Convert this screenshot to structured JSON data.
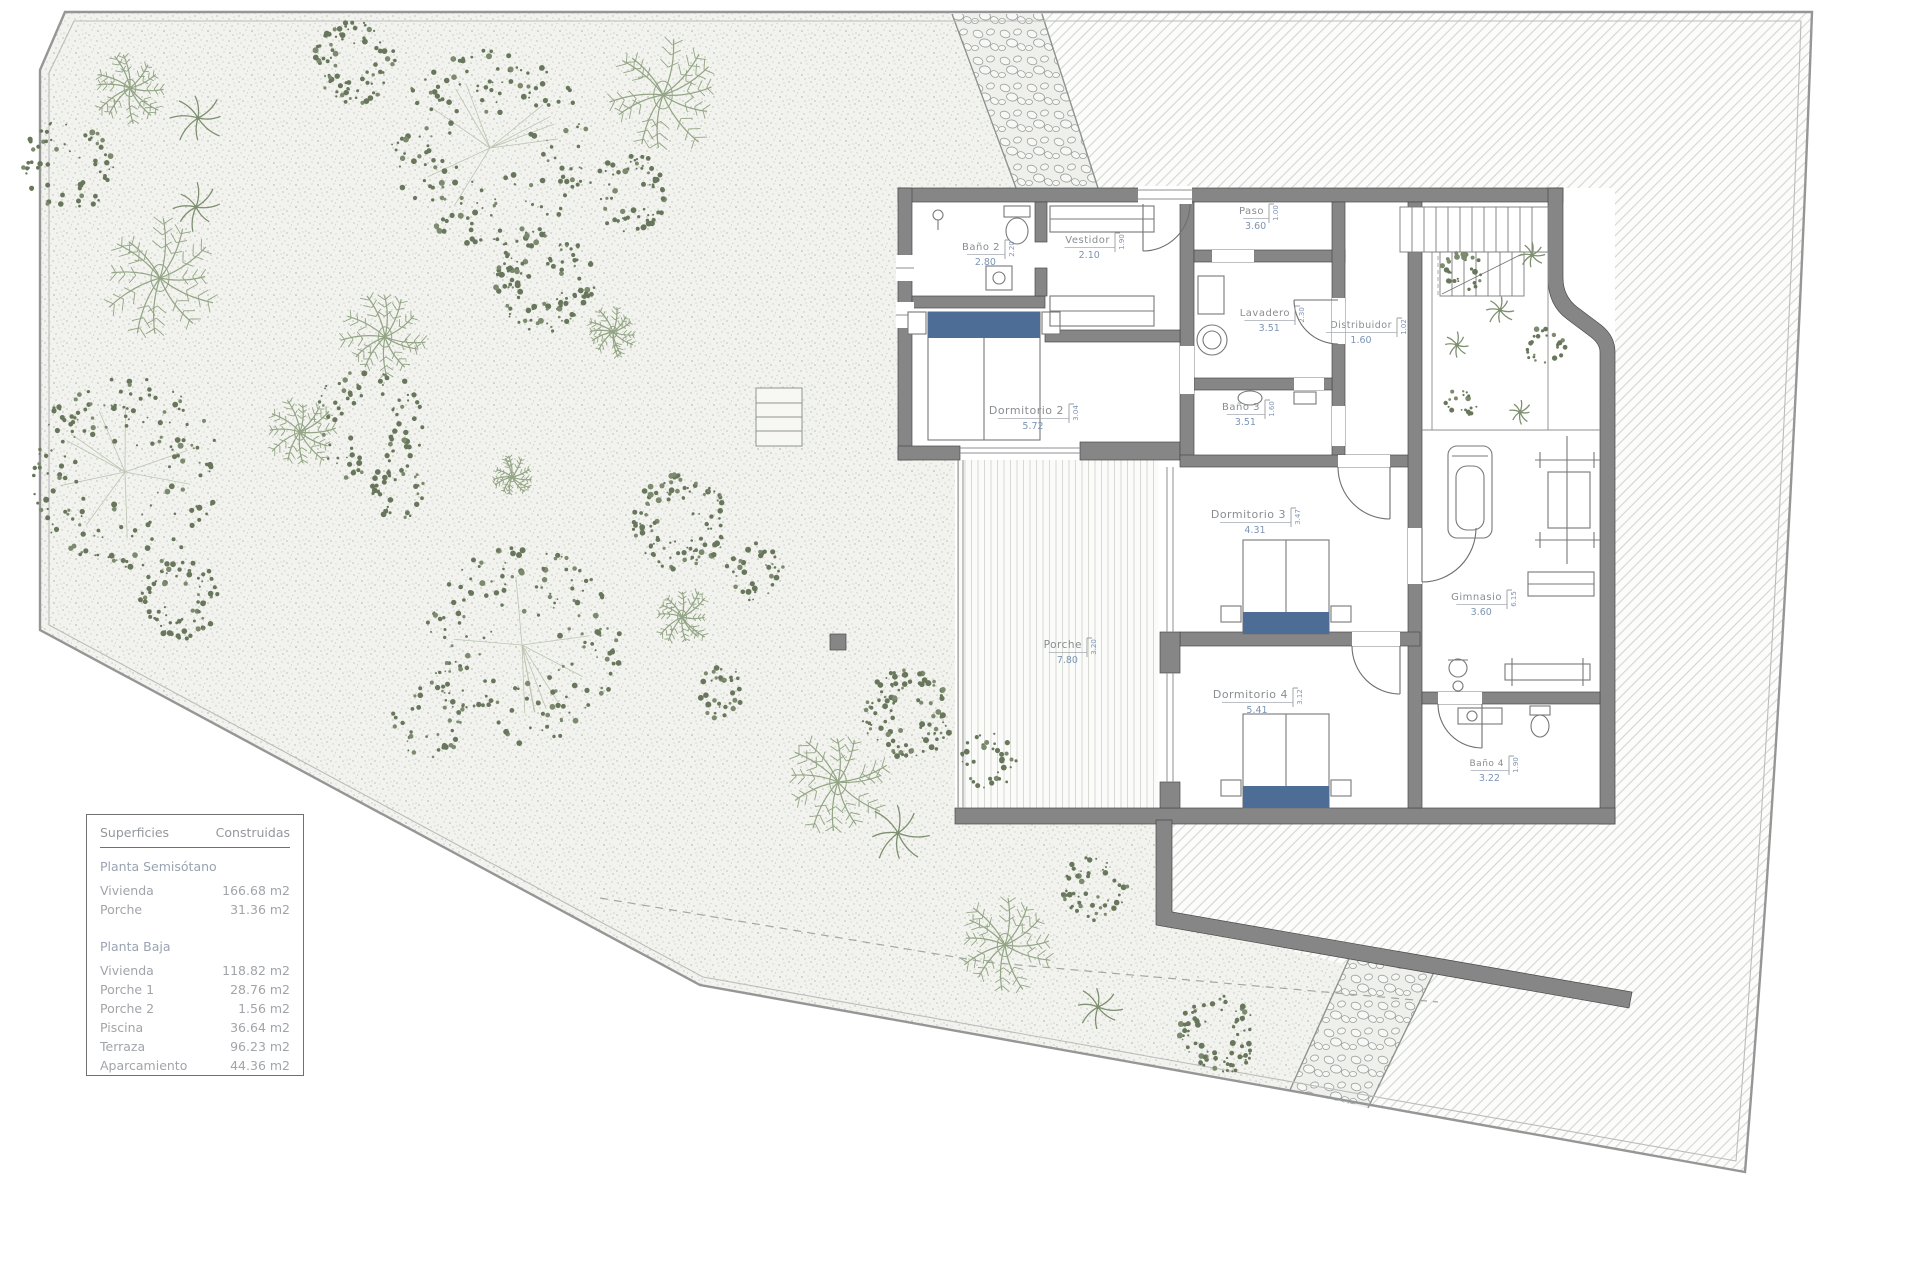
{
  "legend": {
    "header_left": "Superficies",
    "header_right": "Construidas",
    "sections": [
      {
        "title": "Planta Semisótano",
        "rows": [
          {
            "label": "Vivienda",
            "value": "166.68 m2"
          },
          {
            "label": "Porche",
            "value": "31.36 m2"
          }
        ]
      },
      {
        "title": "Planta Baja",
        "rows": [
          {
            "label": "Vivienda",
            "value": "118.82 m2"
          },
          {
            "label": "Porche 1",
            "value": "28.76 m2"
          },
          {
            "label": "Porche 2",
            "value": "1.56 m2"
          },
          {
            "label": "Piscina",
            "value": "36.64 m2"
          },
          {
            "label": "Terraza",
            "value": "96.23 m2"
          },
          {
            "label": "Aparcamiento",
            "value": "44.36 m2"
          }
        ]
      }
    ]
  },
  "plan": {
    "rooms": [
      {
        "name": "Baño 2",
        "w": "2.80",
        "h": "2.20",
        "x": 1004,
        "y": 250,
        "fs": 10
      },
      {
        "name": "Vestidor",
        "w": "2.10",
        "h": "1.90",
        "x": 1114,
        "y": 243,
        "fs": 10
      },
      {
        "name": "Paso",
        "w": "3.60",
        "h": "1.00",
        "x": 1268,
        "y": 214,
        "fs": 10
      },
      {
        "name": "Lavadero",
        "w": "3.51",
        "h": "2.30",
        "x": 1294,
        "y": 316,
        "fs": 10
      },
      {
        "name": "Distribuidor",
        "w": "1.60",
        "h": "1.02",
        "x": 1396,
        "y": 328,
        "fs": 9.5
      },
      {
        "name": "Dormitorio 2",
        "w": "5.72",
        "h": "3.04",
        "x": 1068,
        "y": 414,
        "fs": 11
      },
      {
        "name": "Baño 3",
        "w": "3.51",
        "h": "1.60",
        "x": 1264,
        "y": 410,
        "fs": 10
      },
      {
        "name": "Dormitorio 3",
        "w": "4.31",
        "h": "3.47",
        "x": 1290,
        "y": 518,
        "fs": 11
      },
      {
        "name": "Gimnasio",
        "w": "3.60",
        "h": "6.15",
        "x": 1506,
        "y": 600,
        "fs": 10
      },
      {
        "name": "Porche",
        "w": "7.80",
        "h": "3.20",
        "x": 1086,
        "y": 648,
        "fs": 10.5
      },
      {
        "name": "Dormitorio 4",
        "w": "5.41",
        "h": "3.12",
        "x": 1292,
        "y": 698,
        "fs": 11
      },
      {
        "name": "Baño 4",
        "w": "3.22",
        "h": "1.90",
        "x": 1508,
        "y": 766,
        "fs": 9
      }
    ]
  },
  "garden": {
    "plants": [
      {
        "t": "fern",
        "x": 130,
        "y": 88,
        "r": 36
      },
      {
        "t": "palm",
        "x": 198,
        "y": 118,
        "r": 26
      },
      {
        "t": "canopy",
        "x": 355,
        "y": 62,
        "r": 40,
        "d": 1
      },
      {
        "t": "canopy",
        "x": 68,
        "y": 165,
        "r": 45,
        "d": 0.55
      },
      {
        "t": "canopy",
        "x": 490,
        "y": 148,
        "r": 95,
        "d": 1
      },
      {
        "t": "fern",
        "x": 663,
        "y": 95,
        "r": 58
      },
      {
        "t": "palm",
        "x": 196,
        "y": 207,
        "r": 22
      },
      {
        "t": "canopy",
        "x": 628,
        "y": 192,
        "r": 38,
        "d": 0.8
      },
      {
        "t": "fern",
        "x": 160,
        "y": 278,
        "r": 56
      },
      {
        "t": "canopy",
        "x": 545,
        "y": 282,
        "r": 48,
        "d": 1
      },
      {
        "t": "fern",
        "x": 385,
        "y": 337,
        "r": 42
      },
      {
        "t": "fern",
        "x": 613,
        "y": 332,
        "r": 24
      },
      {
        "t": "canopy",
        "x": 368,
        "y": 425,
        "r": 55,
        "d": 0.5
      },
      {
        "t": "fern",
        "x": 300,
        "y": 432,
        "r": 34
      },
      {
        "t": "canopy",
        "x": 125,
        "y": 472,
        "r": 92,
        "d": 1
      },
      {
        "t": "canopy",
        "x": 398,
        "y": 492,
        "r": 26,
        "d": 0.8
      },
      {
        "t": "fern",
        "x": 512,
        "y": 477,
        "r": 20
      },
      {
        "t": "canopy",
        "x": 680,
        "y": 522,
        "r": 46,
        "d": 1
      },
      {
        "t": "canopy",
        "x": 178,
        "y": 598,
        "r": 40,
        "d": 0.9
      },
      {
        "t": "canopy",
        "x": 755,
        "y": 572,
        "r": 28,
        "d": 0.7
      },
      {
        "t": "canopy",
        "x": 522,
        "y": 645,
        "r": 95,
        "d": 1
      },
      {
        "t": "fern",
        "x": 682,
        "y": 617,
        "r": 28
      },
      {
        "t": "canopy",
        "x": 718,
        "y": 692,
        "r": 26,
        "d": 0.8
      },
      {
        "t": "canopy",
        "x": 430,
        "y": 720,
        "r": 36,
        "d": 0.5
      },
      {
        "t": "canopy",
        "x": 908,
        "y": 715,
        "r": 44,
        "d": 1
      },
      {
        "t": "canopy",
        "x": 988,
        "y": 760,
        "r": 28,
        "d": 0.7
      },
      {
        "t": "fern",
        "x": 838,
        "y": 782,
        "r": 52
      },
      {
        "t": "palm",
        "x": 898,
        "y": 833,
        "r": 28
      },
      {
        "t": "canopy",
        "x": 1095,
        "y": 887,
        "r": 32,
        "d": 0.9
      },
      {
        "t": "fern",
        "x": 1005,
        "y": 945,
        "r": 48
      },
      {
        "t": "palm",
        "x": 1098,
        "y": 1007,
        "r": 22
      },
      {
        "t": "canopy",
        "x": 1218,
        "y": 1035,
        "r": 38,
        "d": 1
      },
      {
        "t": "canopy",
        "x": 1462,
        "y": 272,
        "r": 20,
        "d": 0.9
      },
      {
        "t": "palm",
        "x": 1532,
        "y": 255,
        "r": 12
      },
      {
        "t": "palm",
        "x": 1500,
        "y": 310,
        "r": 14
      },
      {
        "t": "canopy",
        "x": 1545,
        "y": 348,
        "r": 20,
        "d": 0.8
      },
      {
        "t": "palm",
        "x": 1457,
        "y": 345,
        "r": 12
      },
      {
        "t": "canopy",
        "x": 1462,
        "y": 402,
        "r": 16,
        "d": 0.7
      },
      {
        "t": "palm",
        "x": 1520,
        "y": 412,
        "r": 11
      }
    ]
  },
  "colors": {
    "wall": "#868686",
    "wall_edge": "#4a4a4a",
    "bed": "#4e6d96",
    "dim_text": "#7d95b5",
    "label_text": "#8a8d91",
    "plant_dot": "#68775c",
    "plant_frond": "#93a585",
    "fixture": "#787878"
  }
}
